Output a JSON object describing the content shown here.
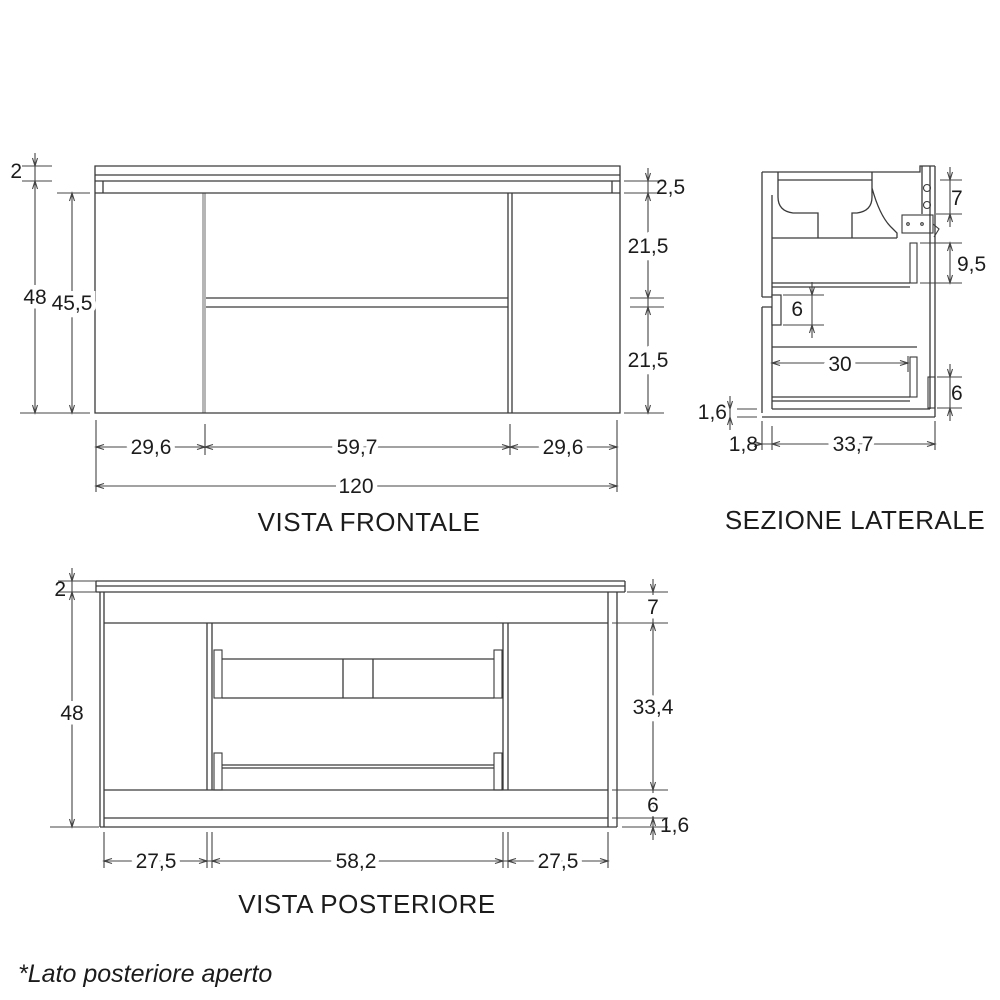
{
  "style": {
    "line_color": "#3a3a3a",
    "dim_color": "#444444",
    "divider_gray": "#b5b5b5",
    "background": "#ffffff"
  },
  "front": {
    "caption": "VISTA FRONTALE",
    "dims": {
      "top_thickness": "2",
      "body_height": "48",
      "door_height": "45,5",
      "top_rail": "2,5",
      "drawer_upper": "21,5",
      "drawer_lower": "21,5",
      "left_width": "29,6",
      "center_width": "59,7",
      "right_width": "29,6",
      "total_width": "120"
    }
  },
  "section": {
    "caption": "SEZIONE LATERALE",
    "dims": {
      "top_gap": "7",
      "back_height": "9,5",
      "drawer_gap": "6",
      "slide_length": "30",
      "bottom_rail": "6",
      "bottom_panel": "1,6",
      "front_thickness": "1,8",
      "depth": "33,7"
    }
  },
  "rear": {
    "caption": "VISTA POSTERIORE",
    "dims": {
      "top_thickness": "2",
      "body_height": "48",
      "top_rail": "7",
      "open_height": "33,4",
      "bottom_rail": "6",
      "bottom_panel": "1,6",
      "left_width": "27,5",
      "center_width": "58,2",
      "right_width": "27,5"
    }
  },
  "footnote": "*Lato posteriore aperto"
}
